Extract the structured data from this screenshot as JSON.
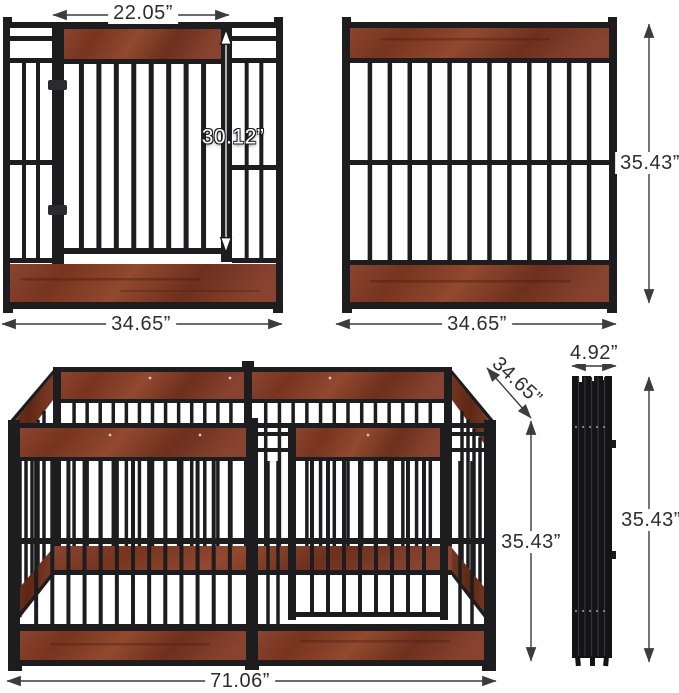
{
  "figures": {
    "gate_panel": {
      "name": "panel with door",
      "gate_width": "22.05”",
      "gate_height": "30.12”",
      "width": "34.65”"
    },
    "plain_panel": {
      "name": "panel without door",
      "height": "35.43”",
      "width": "34.65”"
    },
    "assembled_pen": {
      "name": "assembled dog pen",
      "width": "71.06”",
      "depth": "34.65”",
      "height": "35.43”"
    },
    "folded_panels": {
      "name": "folded panel stack",
      "width": "4.92”",
      "height": "35.43”"
    }
  },
  "colors": {
    "metal": "#1d1d1f",
    "wood": "#83402d",
    "wood_dark": "#6b3020",
    "dimension_line": "#3c3c3c"
  }
}
